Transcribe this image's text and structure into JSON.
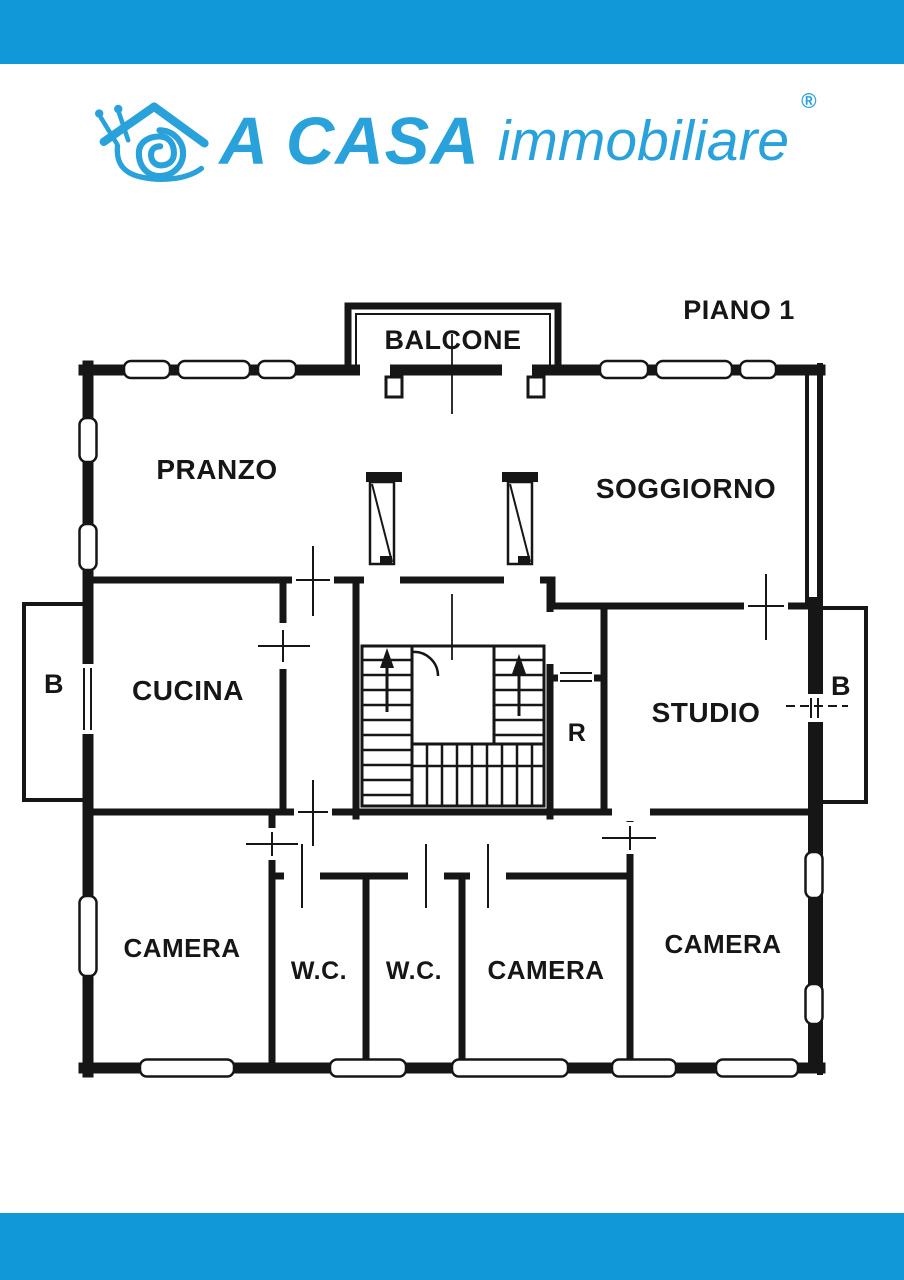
{
  "header_bar": {
    "color": "#1098d8"
  },
  "footer_bar": {
    "color": "#1098d8"
  },
  "logo": {
    "icon": "snail-with-house-roof",
    "color": "#29a2dc",
    "brand_bold": "A CASA",
    "brand_light": "immobiliare",
    "registered_mark": "®"
  },
  "floorplan": {
    "floor_label": "PIANO 1",
    "line_color": "#161616",
    "rooms": {
      "balcone": "BALCONE",
      "pranzo": "PRANZO",
      "soggiorno": "SOGGIORNO",
      "cucina": "CUCINA",
      "balcony_left": "B",
      "balcony_right": "B",
      "studio": "STUDIO",
      "ripostiglio": "R",
      "camera_left": "CAMERA",
      "wc_left": "W.C.",
      "wc_right": "W.C.",
      "camera_center": "CAMERA",
      "camera_right": "CAMERA"
    }
  }
}
